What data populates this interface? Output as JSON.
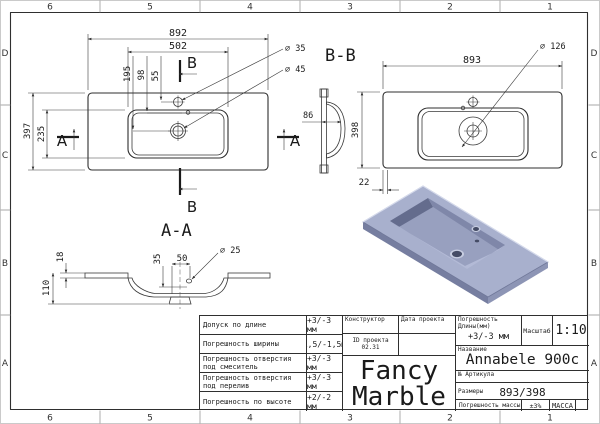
{
  "frame": {
    "columns": [
      "6",
      "5",
      "4",
      "3",
      "2",
      "1"
    ],
    "rows": [
      "D",
      "C",
      "B",
      "A"
    ]
  },
  "plan_view": {
    "section_a": "A",
    "section_b": "B",
    "dim_width": "892",
    "dim_basin_width": "502",
    "dim_drain": "195",
    "dim_overflow": "98",
    "dim_faucet": "55",
    "dim_height": "397",
    "dim_basin_height": "235",
    "callout_faucet_hole": "⌀ 35",
    "callout_drain_hole": "⌀ 45"
  },
  "section_bb": {
    "label": "B-B",
    "dim_width": "893",
    "dim_height": "398",
    "dim_edge": "22",
    "dim_bowl_depth": "86",
    "callout_drain_recess": "⌀ 126"
  },
  "section_aa": {
    "label": "A-A",
    "dim_deck_thickness": "18",
    "dim_total_depth": "110",
    "dim_rim": "35",
    "dim_overflow_offset": "50",
    "callout_overflow_hole": "⌀ 25"
  },
  "title_block": {
    "tolerances": [
      {
        "label": "Допуск по длине",
        "value": "+3/-3 мм"
      },
      {
        "label": "Погрешность ширины",
        "value": "+1,5/-1,5мм"
      },
      {
        "label": "Погрешность отверстия под смеситель",
        "value": "+3/-3 мм"
      },
      {
        "label": "Погрешность отверстия под перелив",
        "value": "+3/-3 мм"
      },
      {
        "label": "Погрешность по высоте",
        "value": "+2/-2 мм"
      }
    ],
    "constructor_label": "Конструктор",
    "date_label": "Дата проекта",
    "project_id_line1": "ID проекта",
    "project_id_line2": "02.31",
    "length_tolerance_label": "Погрешность Длины(мм)",
    "length_tolerance_value": "+3/-3 мм",
    "scale_label": "Масштаб",
    "scale_value": "1:10",
    "name_label": "Название",
    "product_name": "Annabele 900c",
    "article_label": "№ Артикула",
    "size_label": "Размеры",
    "size_value": "893/398",
    "mass_tolerance_label": "Погрешность массы",
    "mass_tolerance_value": "±3%",
    "mass_label": "МАССА",
    "brand_line1": "Fancy",
    "brand_line2": "Marble"
  },
  "render": {
    "top": "#a8b0cd",
    "side_left": "#767ea0",
    "side_right": "#8d95b5",
    "wall_dark": "#646c8d",
    "wall_far": "#7f87a9",
    "floor": "#98a0bf",
    "near_wall": "#b3bad6",
    "hole_dark": "#454c66",
    "hole_rim": "#c7cde1",
    "edge_highlight": "#d6dbec"
  }
}
